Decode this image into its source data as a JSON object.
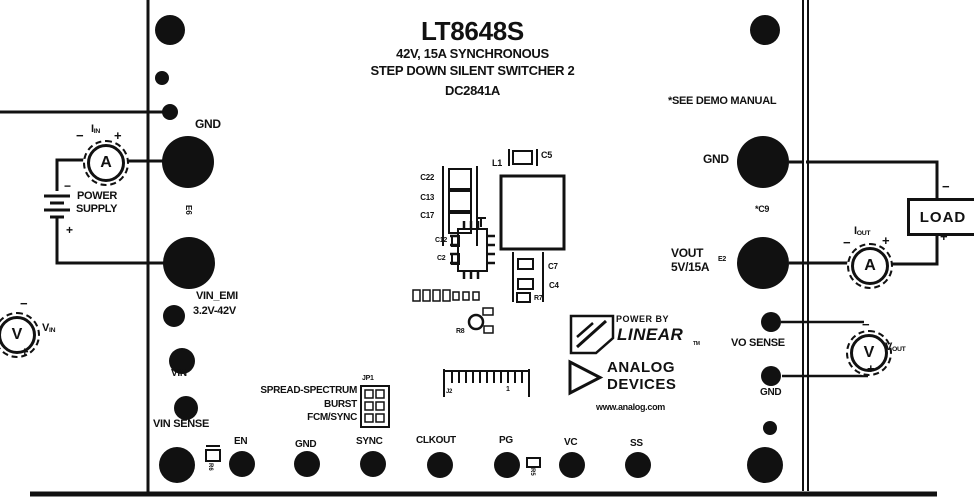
{
  "figure": {
    "title": "LT8648S",
    "subtitle1": "42V, 15A SYNCHRONOUS",
    "subtitle2": "STEP DOWN SILENT SWITCHER 2",
    "board": "DC2841A",
    "note": "*SEE DEMO MANUAL"
  },
  "colors": {
    "ink": "#111111",
    "background": "#ffffff"
  },
  "left": {
    "gnd": "GND",
    "e6": "E6",
    "vin_emi": "VIN_EMI",
    "vin_range": "3.2V-42V",
    "vin": "VIN",
    "vin_sense": "VIN SENSE",
    "power_supply_line1": "POWER",
    "power_supply_line2": "SUPPLY",
    "supply_minus": "−",
    "supply_plus": "+"
  },
  "meters": {
    "iin": {
      "symbol": "A",
      "label": "I",
      "sub": "IN",
      "minus": "−",
      "plus": "+"
    },
    "vin": {
      "symbol": "V",
      "label": "V",
      "sub": "IN",
      "minus": "−",
      "plus": "+"
    },
    "iout": {
      "symbol": "A",
      "label": "I",
      "sub": "OUT",
      "minus": "−",
      "plus": "+"
    },
    "vout": {
      "symbol": "V",
      "label": "V",
      "sub": "OUT",
      "minus": "−",
      "plus": "+"
    }
  },
  "right": {
    "gnd_top": "GND",
    "c9": "*C9",
    "vout": "VOUT",
    "vout_rating": "5V/15A",
    "e2": "E2",
    "vo_sense": "VO SENSE",
    "gnd_bottom": "GND",
    "load": "LOAD",
    "load_minus": "−",
    "load_plus": "+"
  },
  "bottom_pins": [
    "EN",
    "GND",
    "SYNC",
    "CLKOUT",
    "PG",
    "VC",
    "SS"
  ],
  "jumper": {
    "name": "JP1",
    "options": [
      "SPREAD-SPECTRUM",
      "BURST",
      "FCM/SYNC"
    ]
  },
  "components": {
    "c22": "C22",
    "c13": "C13",
    "c17": "C17",
    "l1": "L1",
    "c5": "C5",
    "c12": "C12",
    "c2": "C2",
    "c7": "C7",
    "c4": "C4",
    "r7": "R7",
    "r8": "R8",
    "r6": "R6",
    "r5": "R5",
    "j2": "J2",
    "j2_pin1": "1"
  },
  "branding": {
    "powered_by": "POWER BY",
    "linear": "LINEAR",
    "tm": "TM",
    "analog": "ANALOG",
    "devices": "DEVICES",
    "url": "www.analog.com"
  }
}
